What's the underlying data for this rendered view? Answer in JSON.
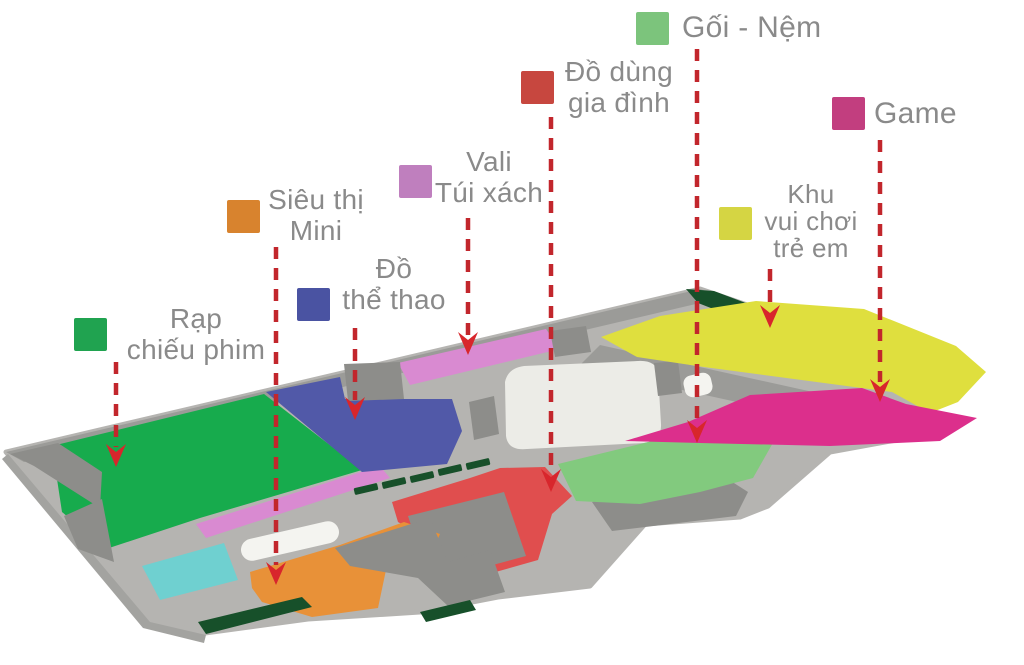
{
  "page": {
    "background": "#ffffff"
  },
  "legend": {
    "text_color": "#8a8a8a",
    "items": [
      {
        "id": "rap-chieu-phim",
        "lines": [
          "Rạp",
          "chiếu phim"
        ],
        "color": "#20a350"
      },
      {
        "id": "sieu-thi-mini",
        "lines": [
          "Siêu thị",
          "Mini"
        ],
        "color": "#d8832e"
      },
      {
        "id": "do-the-thao",
        "lines": [
          "Đồ",
          "thể thao"
        ],
        "color": "#4a53a2"
      },
      {
        "id": "vali-tui-xach",
        "lines": [
          "Vali",
          "Túi xách"
        ],
        "color": "#bf7fbe"
      },
      {
        "id": "do-dung-gia-dinh",
        "lines": [
          "Đồ dùng",
          "gia đình"
        ],
        "color": "#c7473f"
      },
      {
        "id": "goi-nem",
        "lines": [
          "Gối - Nệm"
        ],
        "color": "#7cc47c"
      },
      {
        "id": "khu-vui-choi-tre-em",
        "lines": [
          "Khu",
          "vui chơi",
          "trẻ em"
        ],
        "color": "#d5d543"
      },
      {
        "id": "game",
        "lines": [
          "Game"
        ],
        "color": "#c23e7f"
      }
    ]
  },
  "map": {
    "arrow_color": "#c2262c",
    "arrowhead_color": "#d8262c",
    "zones": {
      "floor_base": {
        "color": "#b5b4b1"
      },
      "wall_band": {
        "color": "#9b9b98"
      },
      "block_gray": {
        "color": "#8d8d8a"
      },
      "rim": {
        "color": "#a3a3a0"
      },
      "cinema": {
        "color": "#17ab4d"
      },
      "supermarket": {
        "color": "#e89138"
      },
      "sports": {
        "color": "#5159a8"
      },
      "luggage": {
        "color": "#d98ad1"
      },
      "household": {
        "color": "#e04e4e"
      },
      "pillows": {
        "color": "#82ca7e"
      },
      "kids": {
        "color": "#dfdf3e"
      },
      "game": {
        "color": "#dc2f8c"
      },
      "pool": {
        "color": "#6fd0d0"
      },
      "dark_green": {
        "color": "#17502a"
      },
      "atrium": {
        "color": "#ecece7"
      },
      "white_block": {
        "color": "#f4f4f0"
      }
    }
  }
}
